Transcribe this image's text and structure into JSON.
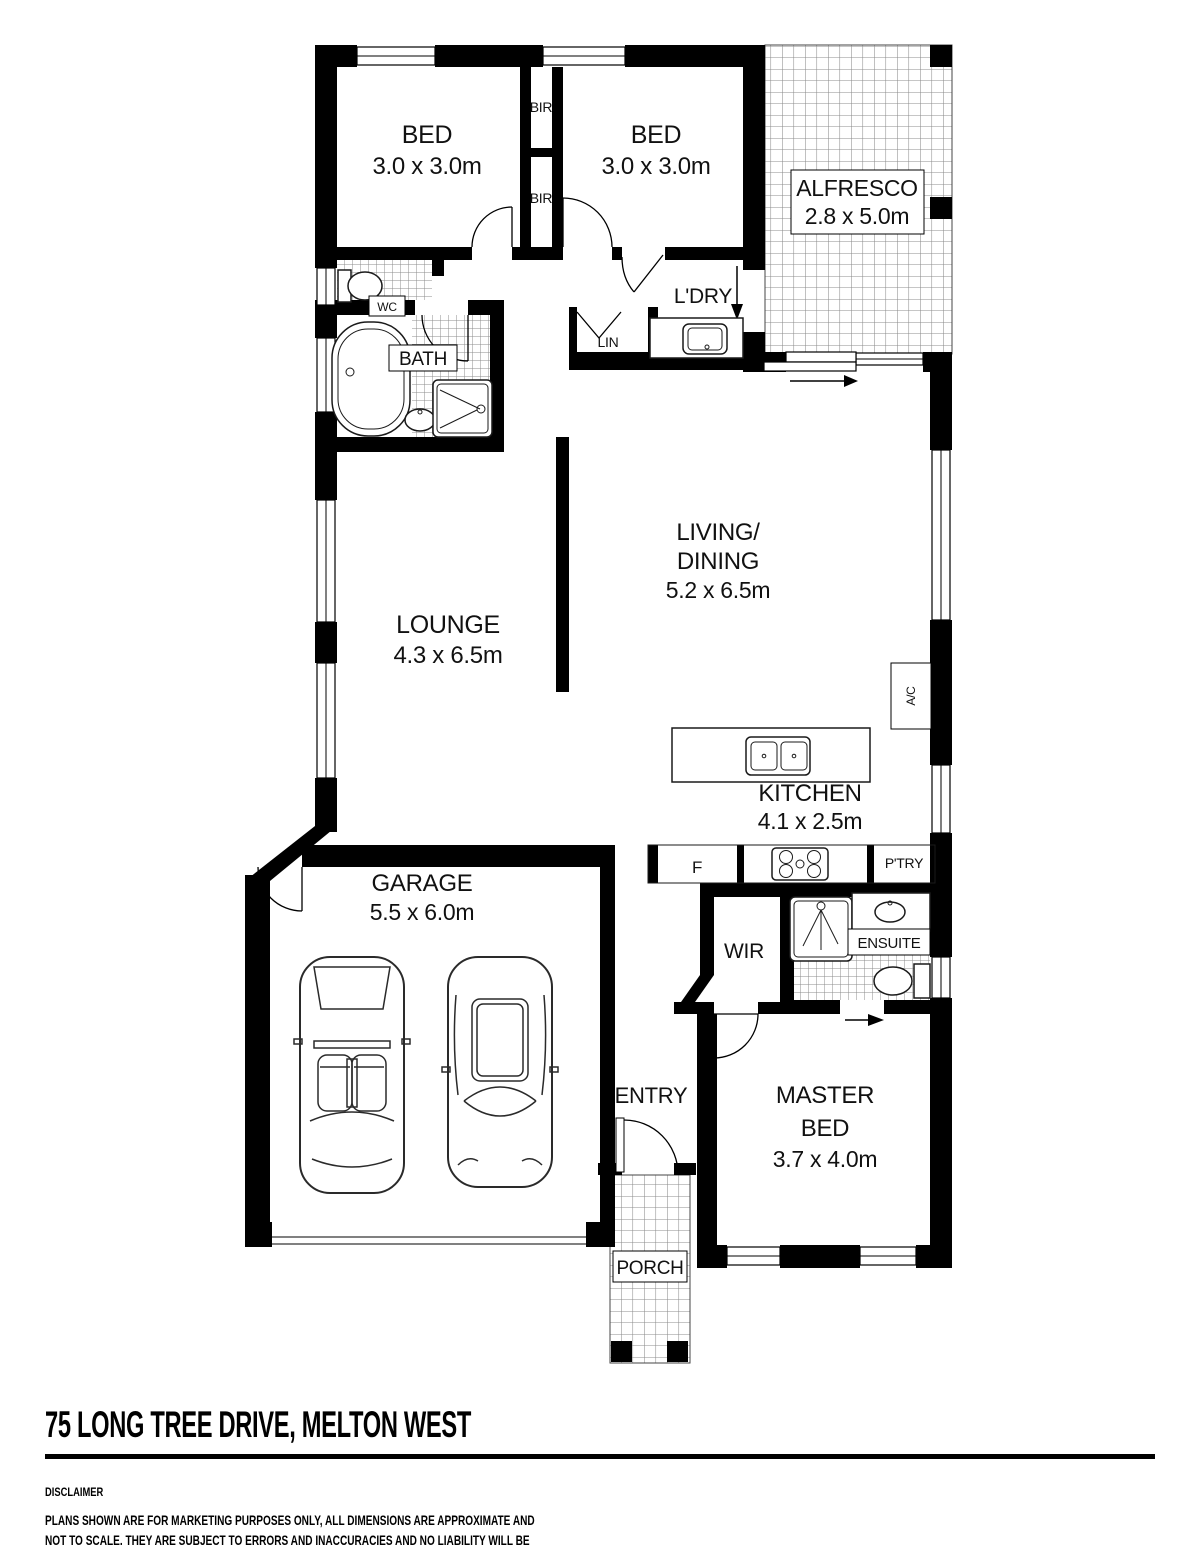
{
  "plan": {
    "rooms": {
      "bed1": {
        "name": "BED",
        "dims": "3.0 x 3.0m"
      },
      "bed2": {
        "name": "BED",
        "dims": "3.0 x 3.0m"
      },
      "alfresco": {
        "name": "ALFRESCO",
        "dims": "2.8 x 5.0m"
      },
      "lounge": {
        "name": "LOUNGE",
        "dims": "4.3 x 6.5m"
      },
      "living": {
        "name1": "LIVING/",
        "name2": "DINING",
        "dims": "5.2 x 6.5m"
      },
      "kitchen": {
        "name": "KITCHEN",
        "dims": "4.1 x 2.5m"
      },
      "garage": {
        "name": "GARAGE",
        "dims": "5.5 x 6.0m"
      },
      "master": {
        "name1": "MASTER",
        "name2": "BED",
        "dims": "3.7 x 4.0m"
      },
      "entry": {
        "name": "ENTRY"
      },
      "porch": {
        "name": "PORCH"
      },
      "wir": {
        "name": "WIR"
      },
      "ensuite": {
        "name": "ENSUITE"
      },
      "bath": {
        "name": "BATH"
      },
      "wc": {
        "name": "WC"
      },
      "ldry": {
        "name": "L'DRY"
      },
      "lin": {
        "name": "LIN"
      }
    },
    "labels": {
      "bir_upper": "BIR",
      "bir_lower": "BIR",
      "ac": "A/C",
      "fridge": "F",
      "pantry": "P'TRY"
    },
    "fixtures": [
      "bathtub",
      "shower",
      "toilet",
      "vanity-sink",
      "laundry-trough",
      "kitchen-double-sink",
      "cooktop",
      "car",
      "car"
    ]
  },
  "footer": {
    "address_title": "75 LONG TREE DRIVE, MELTON WEST",
    "disclaimer_heading": "DISCLAIMER",
    "disclaimer_body": "PLANS SHOWN ARE FOR MARKETING PURPOSES ONLY, ALL DIMENSIONS ARE APPROXIMATE AND\nNOT TO SCALE. THEY ARE SUBJECT TO ERRORS AND INACCURACIES AND NO LIABILITY WILL BE\nACCEPTED. INTERESTED PARTIES SHOULD MAKE THEIR OWN INQUIRIES."
  },
  "colors": {
    "wall": "#000000",
    "background": "#ffffff",
    "tile_line": "#8c8c8c"
  }
}
